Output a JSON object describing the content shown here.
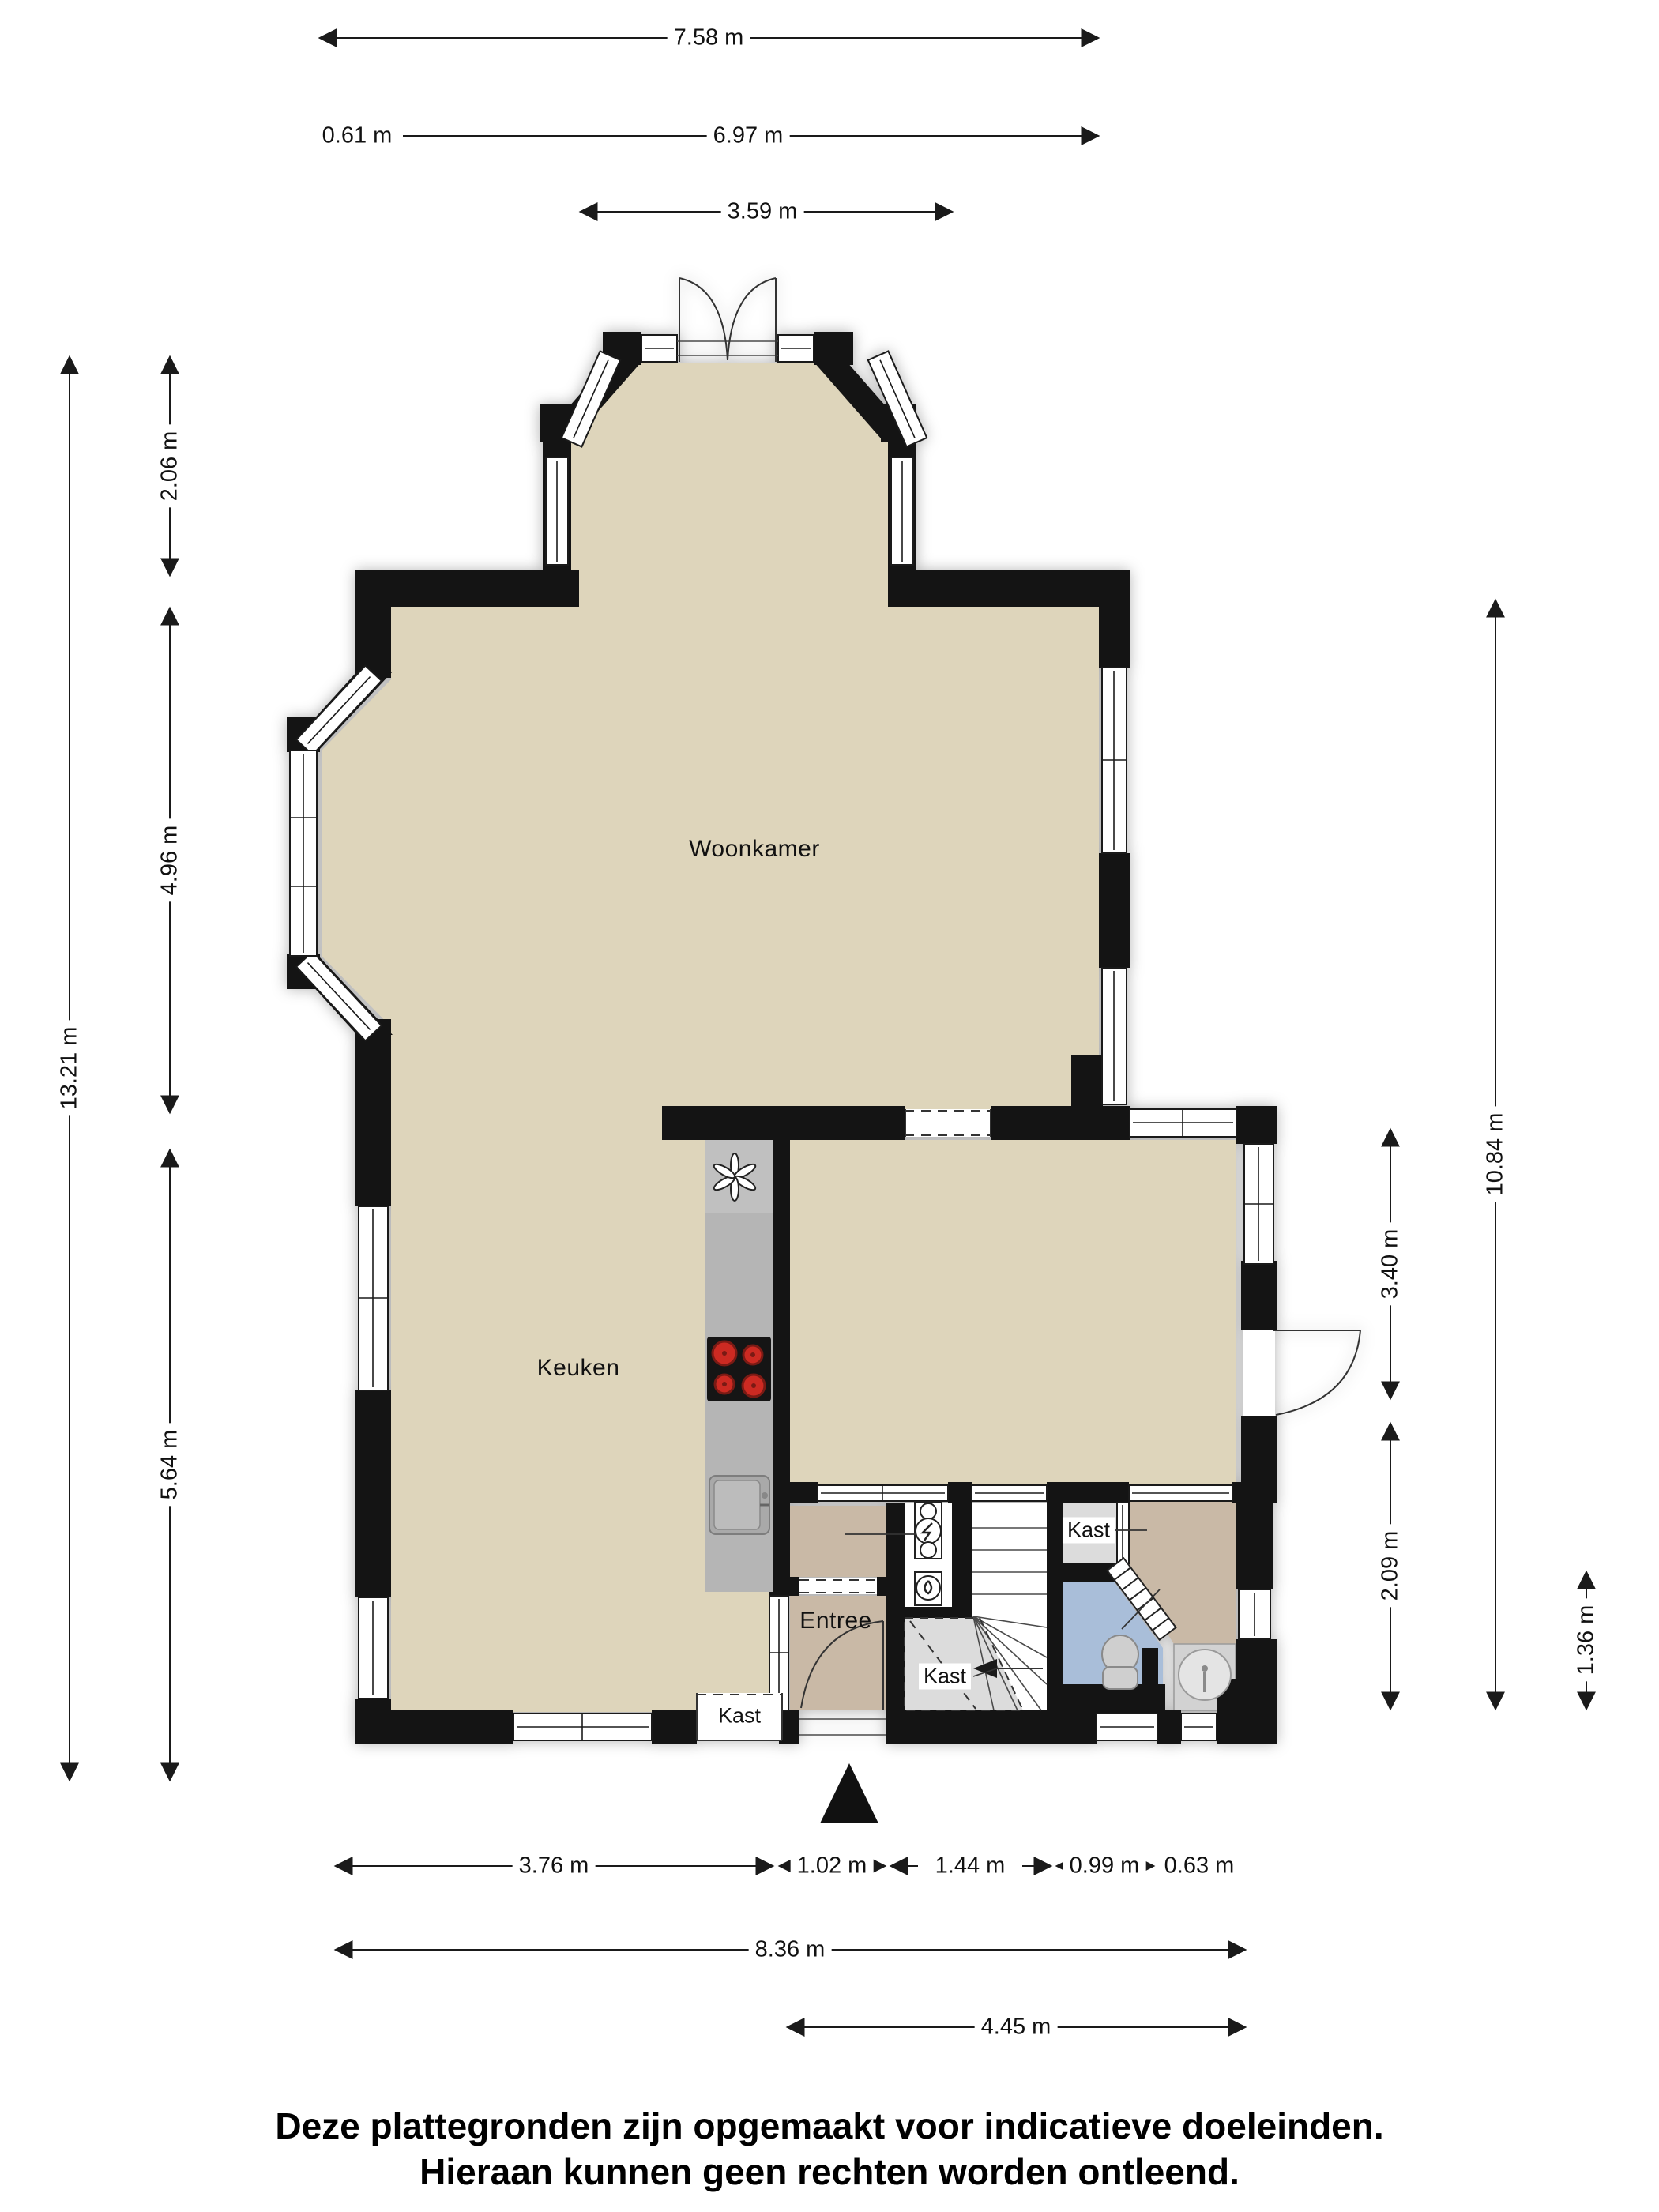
{
  "plan": {
    "type": "floorplan-ground-floor",
    "rooms": {
      "woonkamer": "Woonkamer",
      "keuken": "Keuken",
      "entree": "Entree",
      "kast_stairs": "Kast",
      "kast_upper": "Kast",
      "kast_bottom": "Kast"
    },
    "icons": [
      "north-arrow-icon",
      "extractor-fan-icon",
      "hob-icon",
      "sink-icon",
      "toilet-icon",
      "shower-icon",
      "electric-meter-icon",
      "water-meter-icon",
      "stairs-icon",
      "door-swing-icon"
    ]
  },
  "dims": {
    "top": [
      "7.58 m",
      "0.61 m",
      "6.97 m",
      "3.59 m"
    ],
    "left": [
      "13.21 m",
      "2.06 m",
      "4.96 m",
      "5.64 m"
    ],
    "right": [
      "10.84 m",
      "3.40 m",
      "2.09 m",
      "1.36 m"
    ],
    "bottom": [
      "3.76 m",
      "1.02 m",
      "1.44 m",
      "0.99 m",
      "0.63 m"
    ],
    "bottom2": [
      "8.36 m",
      "4.45 m"
    ]
  },
  "disclaimer": {
    "line1": "Deze plattegronden zijn opgemaakt voor indicatieve doeleinden.",
    "line2": "Hieraan kunnen geen rechten worden ontleend."
  },
  "palette": {
    "wall": "#141414",
    "floor": "#ded5bb",
    "hall": "#c9b9a6",
    "toilet": "#a9bed9",
    "closet": "#dcdcdc",
    "counter": "#b5b5b5",
    "burner": "#cc2a22",
    "stair_line": "#4a4a4a"
  }
}
